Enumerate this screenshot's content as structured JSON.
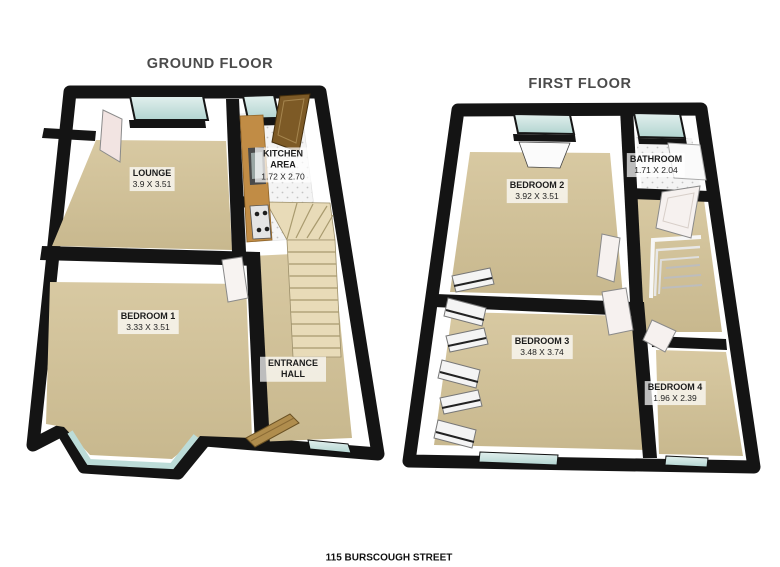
{
  "address": "115 BURSCOUGH STREET",
  "ground_floor": {
    "title": "GROUND FLOOR",
    "rooms": [
      {
        "name": "LOUNGE",
        "dims": "3.9 X 3.51"
      },
      {
        "name": "KITCHEN AREA",
        "dims": "1.72 X 2.70"
      },
      {
        "name": "BEDROOM 1",
        "dims": "3.33 X 3.51"
      },
      {
        "name": "ENTRANCE HALL",
        "dims": ""
      }
    ]
  },
  "first_floor": {
    "title": "FIRST FLOOR",
    "rooms": [
      {
        "name": "BEDROOM 2",
        "dims": "3.92 X 3.51"
      },
      {
        "name": "BATHROOM",
        "dims": "1.71 X 2.04"
      },
      {
        "name": "BEDROOM 3",
        "dims": "3.48 X 3.74"
      },
      {
        "name": "BEDROOM 4",
        "dims": "1.96 X 2.39"
      }
    ]
  },
  "colors": {
    "walls": "#141414",
    "carpet": "#d0c098",
    "window_glass": "#c3e0dc",
    "stairs": "#e8dbb8",
    "kitchen_counter": "#c18c45",
    "kitchen_door": "#7d5a26",
    "entrance_door": "#b08d4d",
    "title_text": "#4b4b4b",
    "label_text": "#1c1c1c"
  }
}
